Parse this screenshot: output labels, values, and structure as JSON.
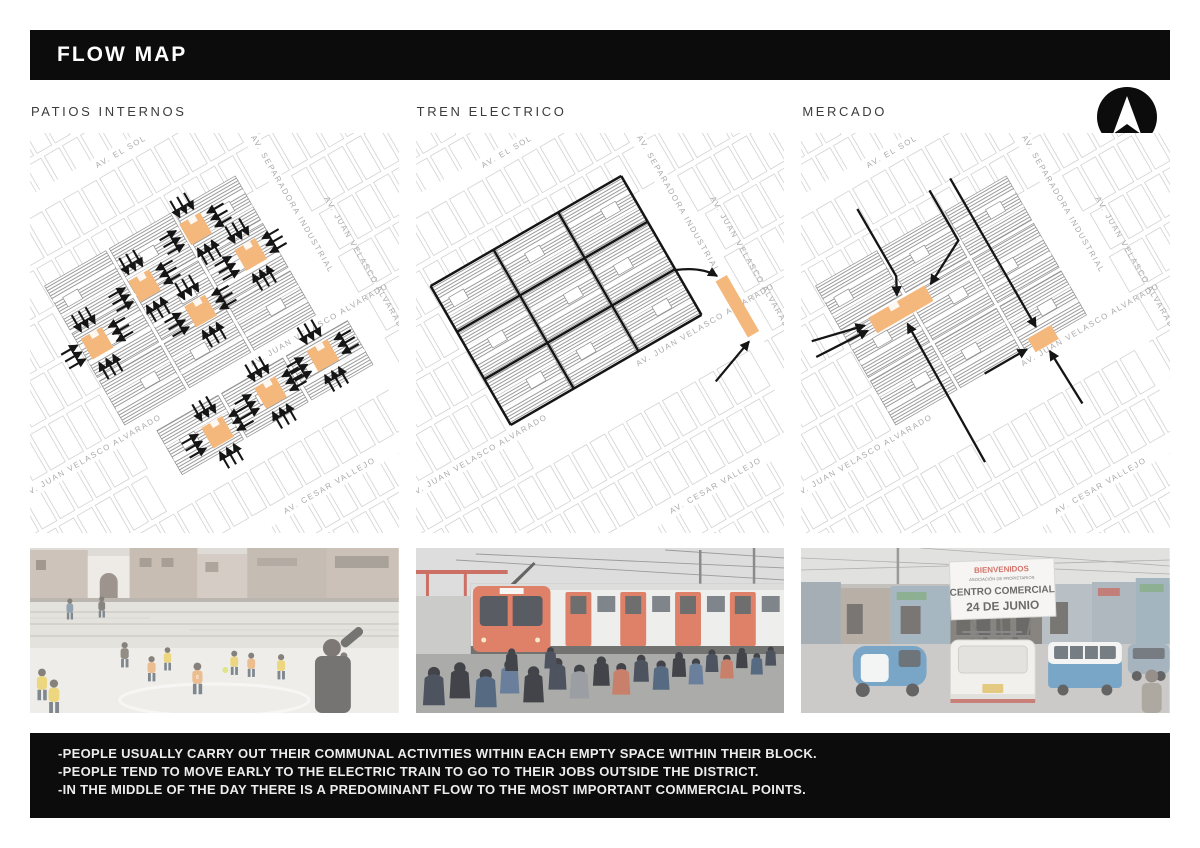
{
  "title": "FLOW MAP",
  "panels": [
    {
      "label": "PATIOS INTERNOS"
    },
    {
      "label": "TREN ELECTRICO"
    },
    {
      "label": "MERCADO"
    }
  ],
  "streets": {
    "el_sol": "AV. EL SOL",
    "separadora": "AV. SEPARADORA INDUSTRIAL",
    "juan_velasco": "AV. JUAN VELASCO ALVARADO",
    "cesar_vallejo": "AV. CESAR VALLEJO"
  },
  "market_sign": {
    "line1": "BIENVENIDOS",
    "line2": "ASOCIACIÓN DE PROPIETARIOS",
    "line3": "CENTRO COMERCIAL",
    "line4": "24 DE JUNIO"
  },
  "photo1_jerseys": [
    "8",
    "13"
  ],
  "footer": {
    "lines": [
      "-PEOPLE USUALLY CARRY OUT THEIR COMMUNAL ACTIVITIES WITHIN EACH EMPTY SPACE WITHIN THEIR BLOCK.",
      "-PEOPLE TEND TO MOVE EARLY TO THE ELECTRIC TRAIN TO GO TO THEIR JOBS OUTSIDE THE DISTRICT.",
      "-IN THE MIDDLE OF THE DAY THERE IS A PREDOMINANT FLOW TO THE MOST IMPORTANT COMMERCIAL POINTS."
    ]
  },
  "colors": {
    "highlight_orange": "#f4b77c",
    "flow_black": "#151515",
    "bar_black": "#0c0c0c"
  }
}
